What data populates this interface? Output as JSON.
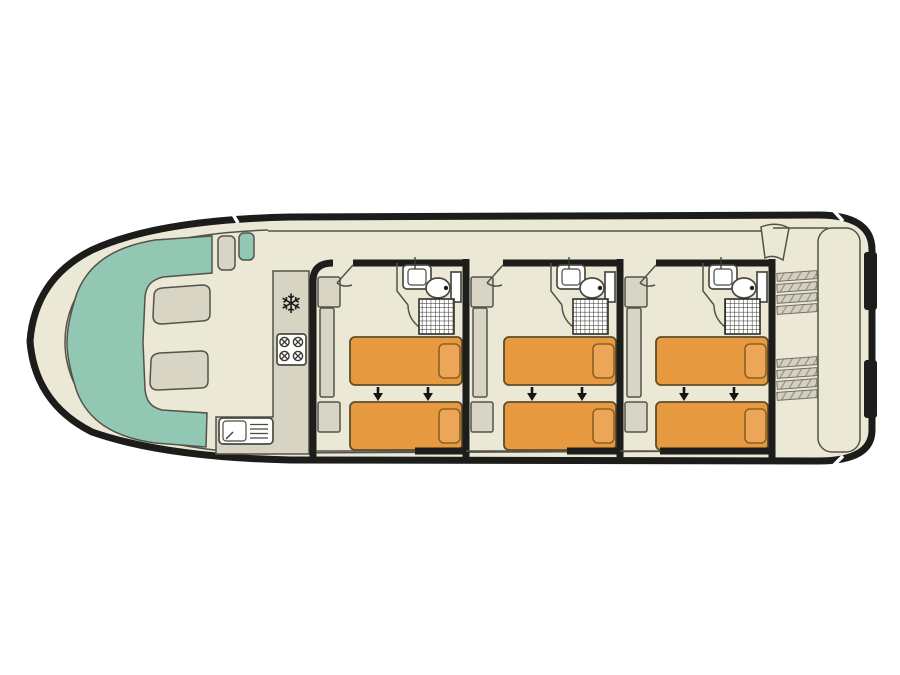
{
  "document": {
    "kind": "houseboat deck plan drawing",
    "orientation": "bow at left, stern at right"
  },
  "colors": {
    "background": "#ffffff",
    "hull_outline": "#1d1d1b",
    "floor": "#ebe8d5",
    "seating": "#91c7b3",
    "furniture": "#d9d5c4",
    "counter": "#d8d4c3",
    "bed": "#e6993f",
    "pillow": "#eda658",
    "fixture": "#ffffff",
    "thin_outline": "#54534a",
    "arrow": "#151513",
    "tread": "#d3d0c1",
    "tread_hatch": "#9a978a",
    "snowflake": "#1a1a18"
  },
  "vessel": {
    "bow_lounge": {
      "sofa_shape": "C-shaped bench seating",
      "table_count": 2,
      "helm_seat_count": 2
    },
    "galley": {
      "fridge_symbol": "❄",
      "burner_count": 4,
      "has_sink_with_drainer": true
    },
    "cabins": [
      {
        "id": "cabin-1",
        "single_beds": 2,
        "pillows": 2,
        "bed_join_arrows": 2,
        "wardrobe_units": 3,
        "ensuite": {
          "washbasin": true,
          "toilet": true,
          "shower": true
        }
      },
      {
        "id": "cabin-2",
        "single_beds": 2,
        "pillows": 2,
        "bed_join_arrows": 2,
        "wardrobe_units": 3,
        "ensuite": {
          "washbasin": true,
          "toilet": true,
          "shower": true
        }
      },
      {
        "id": "cabin-3",
        "single_beds": 2,
        "pillows": 2,
        "bed_join_arrows": 2,
        "wardrobe_units": 3,
        "ensuite": {
          "washbasin": true,
          "toilet": true,
          "shower": true
        }
      }
    ],
    "stern_deck": {
      "stair_flights": 2,
      "treads_per_flight": 4,
      "side_fenders": 2
    }
  }
}
